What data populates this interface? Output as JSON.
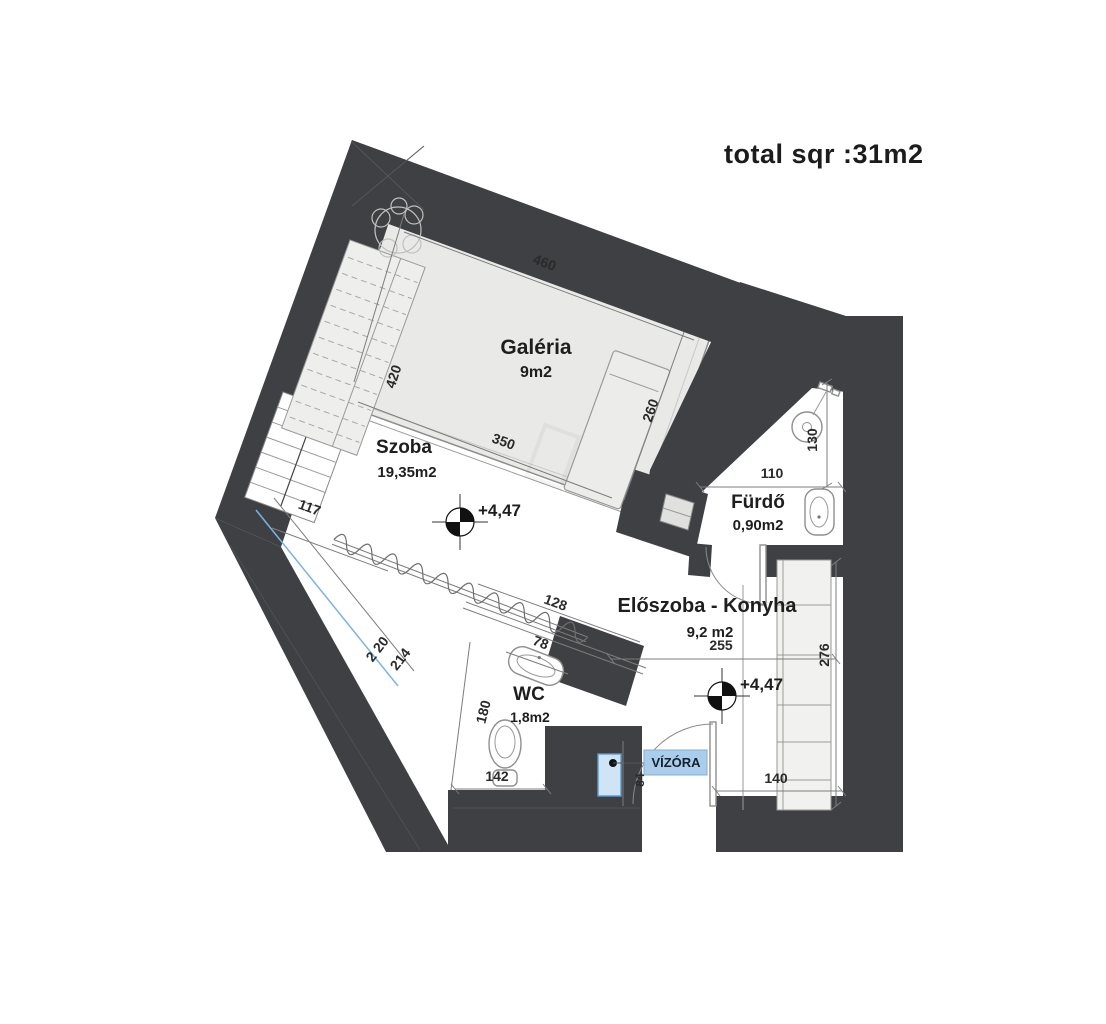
{
  "title": "total sqr :31m2",
  "rooms": {
    "galeria": {
      "name": "Galéria",
      "area": "9m2"
    },
    "szoba": {
      "name": "Szoba",
      "area": "19,35m2"
    },
    "furdo": {
      "name": "Fürdő",
      "area": "0,90m2"
    },
    "eloszoba": {
      "name": "Előszoba - Konyha",
      "area": "9,2 m2"
    },
    "wc": {
      "name": "WC",
      "area": "1,8m2"
    }
  },
  "labels": {
    "water_meter": "VÍZÓRA",
    "elevation": "+4,47"
  },
  "dimensions": {
    "galeria_top": "460",
    "galeria_left": "420",
    "galeria_bottom": "350",
    "galeria_right": "260",
    "szoba_left_wall": "117",
    "szoba_wc_wall": "128",
    "wc_sink": "78",
    "wc_left_wall": "180",
    "wc_bottom": "142",
    "furdo_width": "110",
    "furdo_height": "130",
    "eloszoba_width": "255",
    "eloszoba_height": "276",
    "entry_width": "140",
    "water_meter_offset": "84",
    "stair_diag_a": "2 20",
    "stair_diag_b": "214"
  },
  "colors": {
    "wall": "#3e4043",
    "wall_shade": "#515457",
    "floor_galeria": "#e9e9e7",
    "highlight_fill": "#a9cdea",
    "accent_blue": "#7ab4e3",
    "dim_line": "#7d7d7d",
    "text": "#222222"
  }
}
